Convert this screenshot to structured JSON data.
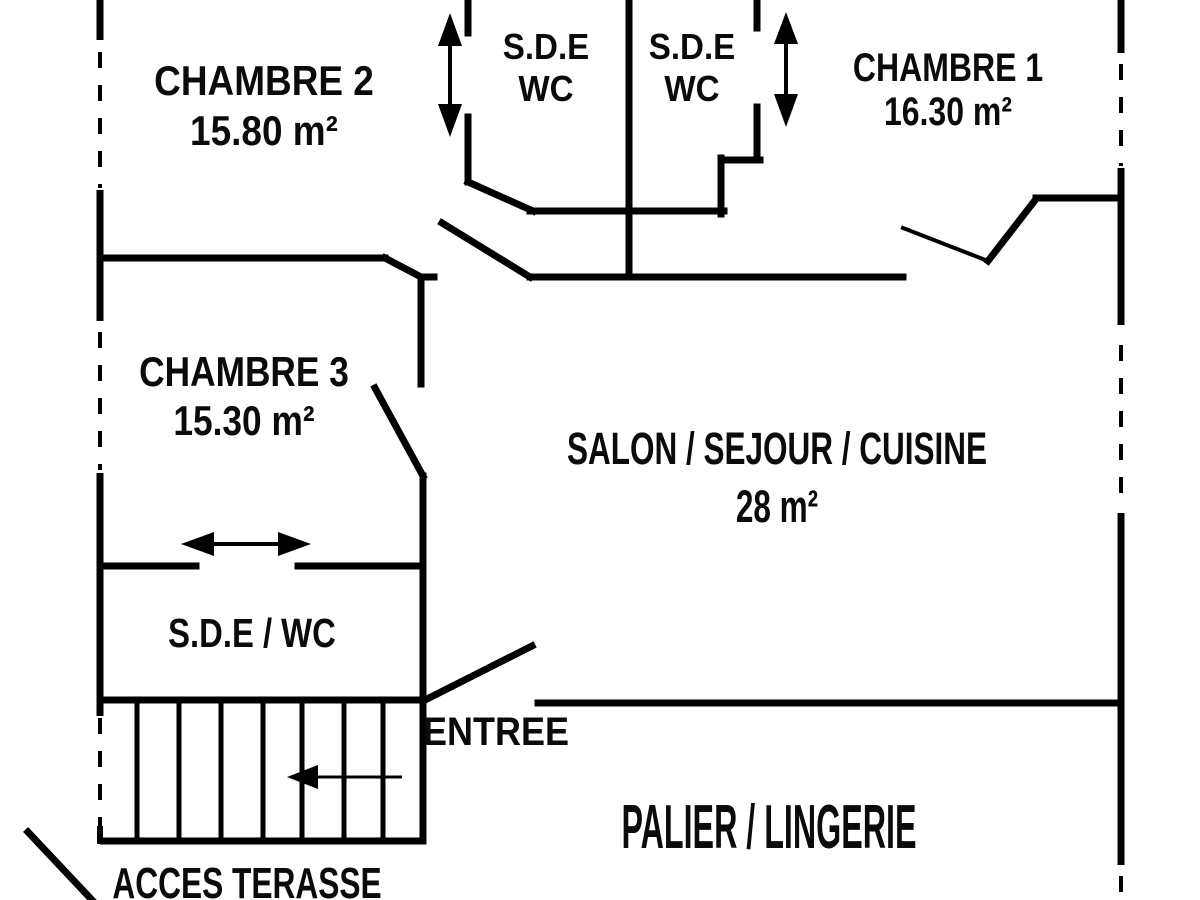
{
  "colors": {
    "line": "#000000",
    "background": "#ffffff",
    "text": "#0b0b0b"
  },
  "rooms": {
    "chambre2": {
      "name": "CHAMBRE 2",
      "area": "15.80 m²"
    },
    "sde_top_left": {
      "name": "S.D.E",
      "area": "WC"
    },
    "sde_top_right": {
      "name": "S.D.E",
      "area": "WC"
    },
    "chambre1": {
      "name": "CHAMBRE 1",
      "area": "16.30 m²"
    },
    "chambre3": {
      "name": "CHAMBRE 3",
      "area": "15.30 m²"
    },
    "salon": {
      "name": "SALON / SEJOUR / CUISINE",
      "area": "28 m²"
    },
    "sde_wc": {
      "name": "S.D.E / WC"
    },
    "entree": {
      "name": "ENTREE"
    },
    "palier": {
      "name": "PALIER / LINGERIE"
    },
    "acces_terasse": {
      "name": "ACCES TERASSE"
    }
  },
  "icons": {
    "sliding_door_vertical_arrow": "↕",
    "sliding_door_horizontal_arrow": "↔",
    "stairs_direction_arrow": "←"
  }
}
